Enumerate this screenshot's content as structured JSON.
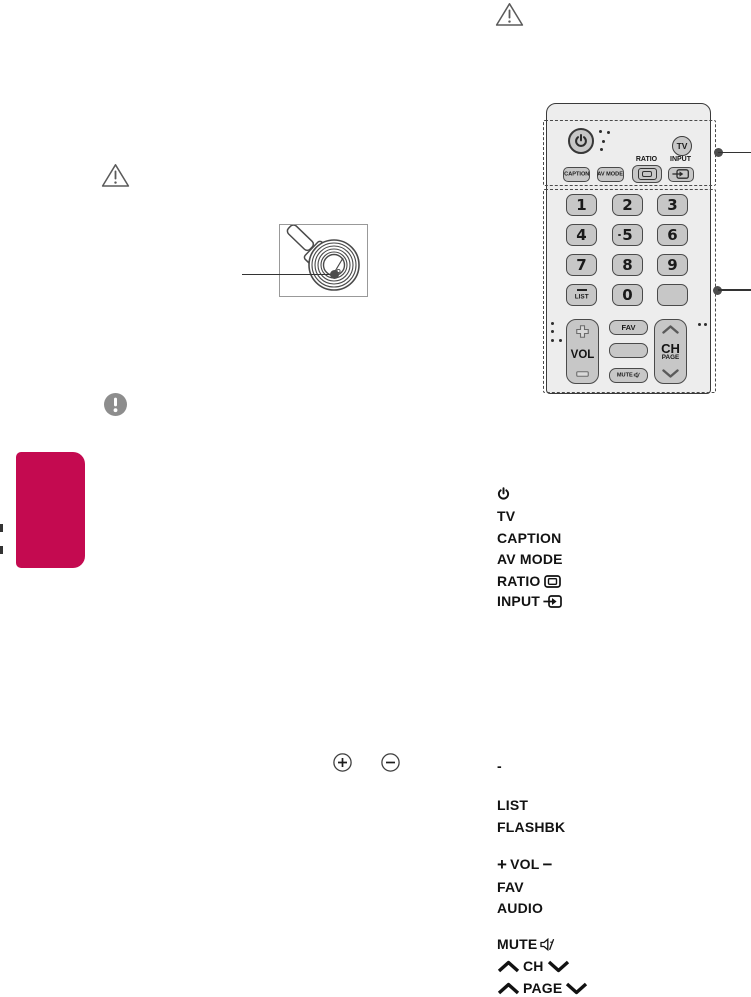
{
  "colors": {
    "accent_pink": "#c40a50",
    "remote_body_fill": "#ededed",
    "key_fill": "#c7c7c7",
    "outline_dark": "#3a3a3a",
    "figure_border_gray": "#999999",
    "note_icon_gray": "#8d8d8d"
  },
  "remote": {
    "tv_button": "TV",
    "caption_button": "CAPTION",
    "av_mode_button": "AV MODE",
    "ratio_label": "RATIO",
    "input_label": "INPUT",
    "keys": {
      "k1": "1",
      "k2": "2",
      "k3": "3",
      "k4": "4",
      "k5": "5",
      "k6": "6",
      "k7": "7",
      "k8": "8",
      "k9": "9",
      "k0": "0"
    },
    "list_key": "LIST",
    "vol_label": "VOL",
    "fav_key": "FAV",
    "mute_key": "MUTE",
    "ch_label": "CH",
    "page_label": "PAGE"
  },
  "legend_top": {
    "tv": "TV",
    "caption": "CAPTION",
    "av_mode": "AV MODE",
    "ratio": "RATIO",
    "input": "INPUT"
  },
  "legend_bottom": {
    "dash": "-",
    "list": "LIST",
    "flashbk": "FLASHBK",
    "vol_plus": "+",
    "vol": "VOL",
    "vol_minus": "−",
    "fav": "FAV",
    "audio": "AUDIO",
    "mute": "MUTE",
    "ch": "CH",
    "page": "PAGE"
  }
}
